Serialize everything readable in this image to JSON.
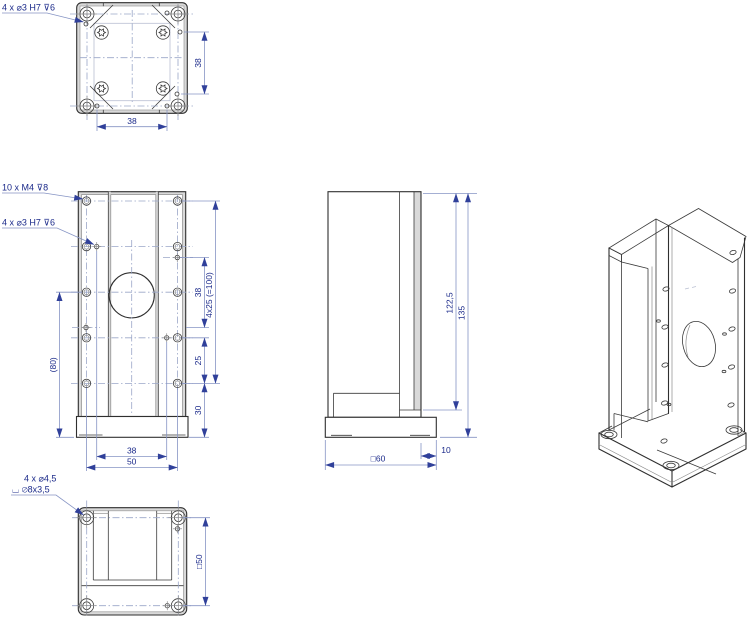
{
  "colors": {
    "background": "#ffffff",
    "part_line": "#2f2f2f",
    "dimension_line": "#8694c4",
    "dimension_text": "#1b2a8a",
    "centerline": "#9aa6c8",
    "edge_shading": "#d9d9d9",
    "arrow": "#30409a"
  },
  "views": {
    "top": {
      "callout": "4 x ⌀3 H7 ⊽6",
      "dim_height": "38",
      "dim_width": "38"
    },
    "front": {
      "callout_m4": "10 x M4 ⊽8",
      "callout_dowel": "4 x ⌀3 H7 ⊽6",
      "dim_dowel_v": "38",
      "dim_pattern": "4x25 (=100)",
      "dim_25": "25",
      "dim_30": "30",
      "dim_80": "(80)",
      "dim_dowel_h": "38",
      "dim_holes_h": "50"
    },
    "side": {
      "dim_plate_height": "122,5",
      "dim_total_height": "135",
      "dim_base": "□60",
      "dim_offset": "10"
    },
    "bottom": {
      "callout_line1": "4 x ⌀4,5",
      "callout_line2": "⌴ ⌀8x3,5",
      "dim_holes": "□50"
    }
  }
}
